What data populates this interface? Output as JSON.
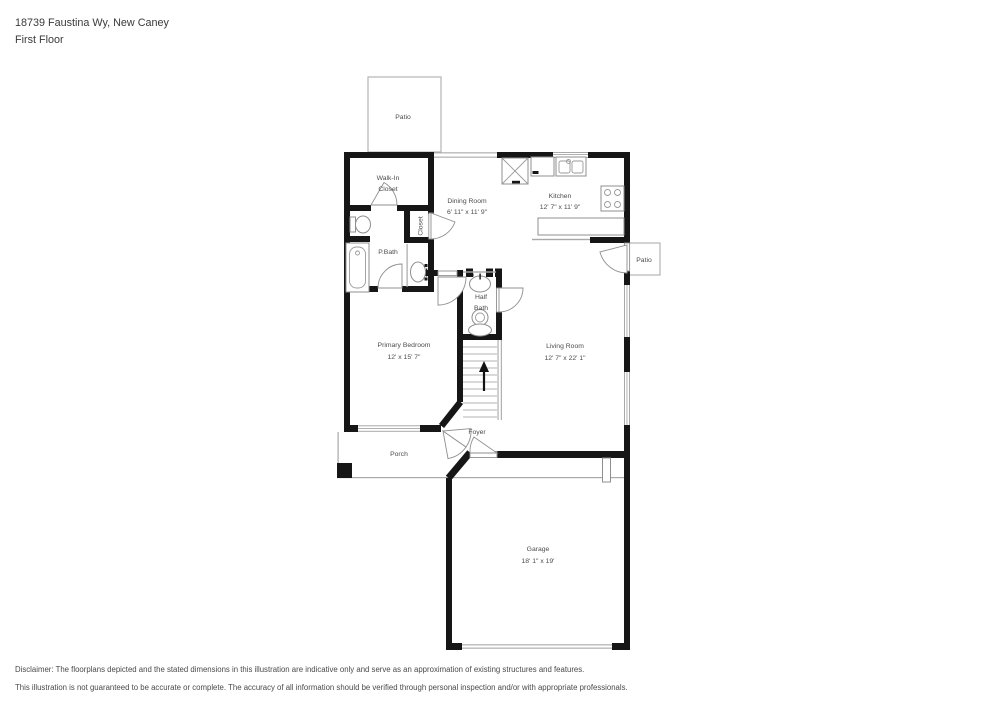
{
  "header": {
    "address": "18739 Faustina Wy, New Caney",
    "floor": "First Floor"
  },
  "rooms": {
    "patio_top": {
      "label": "Patio"
    },
    "walk_in_closet": {
      "line1": "Walk-In",
      "line2": "Closet"
    },
    "dining": {
      "label": "Dining Room",
      "dims": "6' 11\" x 11' 9\""
    },
    "kitchen": {
      "label": "Kitchen",
      "dims": "12' 7\" x 11' 9\""
    },
    "closet": {
      "label": "Closet"
    },
    "pbath": {
      "label": "P.Bath"
    },
    "half_bath": {
      "line1": "Half",
      "line2": "Bath"
    },
    "patio_right": {
      "label": "Patio"
    },
    "primary_bedroom": {
      "label": "Primary Bedroom",
      "dims": "12' x 15' 7\""
    },
    "living": {
      "label": "Living Room",
      "dims": "12' 7\" x 22' 1\""
    },
    "foyer": {
      "label": "Foyer"
    },
    "porch": {
      "label": "Porch"
    },
    "garage": {
      "label": "Garage",
      "dims": "18' 1\" x 19'"
    }
  },
  "stairs": {
    "direction_icon": "up-arrow"
  },
  "disclaimer": {
    "line1": "Disclaimer: The floorplans depicted and the stated dimensions in this illustration are indicative only and serve as an approximation of existing structures and features.",
    "line2": "This illustration is not guaranteed to be accurate or complete. The accuracy of all information should be verified through personal inspection and/or with appropriate professionals."
  },
  "colors": {
    "wall": "#161616",
    "thin_line": "#a9a9a9",
    "label_text": "#4c4c4c",
    "background": "#ffffff"
  }
}
